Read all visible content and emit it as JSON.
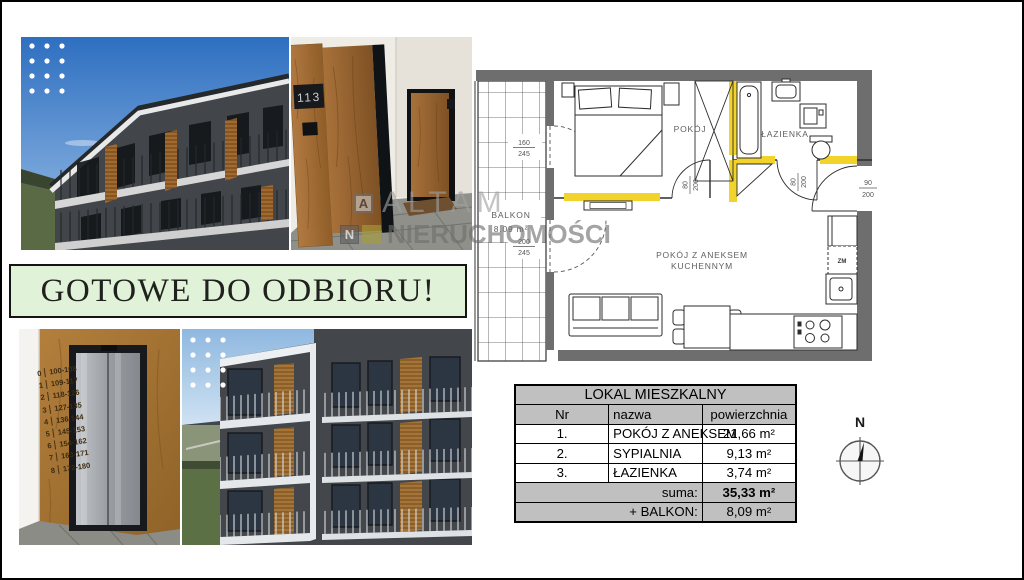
{
  "banner": {
    "text": "GOTOWE DO ODBIORU!"
  },
  "watermark": {
    "icon_a": "A",
    "line1": "ALTAM",
    "icon_n": "N",
    "line2": "NIERUCHOMOŚCI"
  },
  "photos": {
    "hallway": {
      "door_number": "113"
    },
    "elevator": {
      "floors": [
        {
          "f": "0",
          "r": "100-108"
        },
        {
          "f": "1",
          "r": "109-117"
        },
        {
          "f": "2",
          "r": "118-126"
        },
        {
          "f": "3",
          "r": "127-135"
        },
        {
          "f": "4",
          "r": "136-144"
        },
        {
          "f": "5",
          "r": "145-153"
        },
        {
          "f": "6",
          "r": "154-162"
        },
        {
          "f": "7",
          "r": "163-171"
        },
        {
          "f": "8",
          "r": "172-180"
        }
      ]
    }
  },
  "floorplan": {
    "labels": {
      "bedroom": "POKÓJ",
      "bathroom": "ŁAZIENKA",
      "living_line1": "POKÓJ Z ANEKSEM",
      "living_line2": "KUCHENNYM",
      "balcony": "BALKON",
      "balcony_area": "8.09 m²",
      "dishwasher": "ZM"
    },
    "dims": {
      "balcony_door_top": {
        "num": "160",
        "den": "245"
      },
      "balcony_door_bottom": {
        "num": "200",
        "den": "245"
      },
      "bedroom_door": {
        "num": "80",
        "den": "200"
      },
      "bathroom_door": {
        "num": "80",
        "den": "200"
      },
      "entrance_door": {
        "num": "90",
        "den": "200"
      }
    },
    "colors": {
      "wall": "#6e6e6e",
      "radiator": "#f2d32b"
    }
  },
  "table": {
    "title": "LOKAL MIESZKALNY",
    "columns": {
      "nr": "Nr",
      "name": "nazwa",
      "area": "powierzchnia"
    },
    "rows": [
      {
        "nr": "1.",
        "name": "POKÓJ Z ANEKSEM",
        "area": "21,66 m²"
      },
      {
        "nr": "2.",
        "name": "SYPIALNIA",
        "area": "9,13 m²"
      },
      {
        "nr": "3.",
        "name": "ŁAZIENKA",
        "area": "3,74 m²"
      }
    ],
    "summary_rows": [
      {
        "label": "suma:",
        "value": "35,33 m²"
      },
      {
        "label": "+ BALKON:",
        "value": "8,09 m²"
      }
    ]
  },
  "compass": {
    "label": "N"
  }
}
